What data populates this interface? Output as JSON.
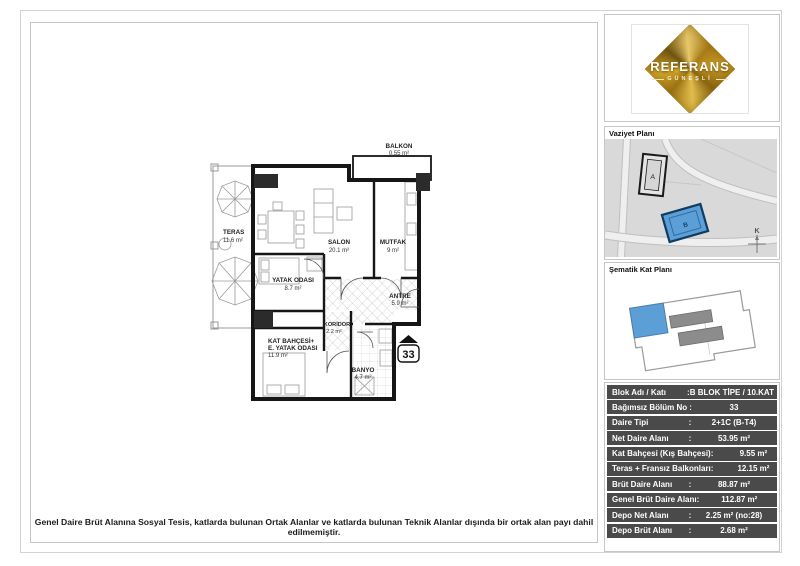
{
  "logo": {
    "name": "REFERANS",
    "subtitle": "GÜNEŞLİ"
  },
  "site_plan": {
    "title": "Vaziyet Planı",
    "building_a": "A",
    "building_b": "B",
    "north": "K"
  },
  "schematic": {
    "title": "Şematik Kat Planı"
  },
  "floor_plan": {
    "unit_number": "33",
    "rooms": {
      "teras": {
        "name": "TERAS",
        "area": "11.6  m²"
      },
      "salon": {
        "name": "SALON",
        "area": "20.1 m²"
      },
      "mutfak": {
        "name": "MUTFAK",
        "area": "9 m²"
      },
      "balkon": {
        "name": "BALKON",
        "area": "0.55 m²"
      },
      "yatak": {
        "name": "YATAK ODASI",
        "area": "8.7 m²"
      },
      "antre": {
        "name": "ANTRE",
        "area": "5.9 m²"
      },
      "koridor": {
        "name": "KORİDOR",
        "area": "2.2 m²"
      },
      "kat_bahcesi": {
        "name1": "KAT BAHÇESİ+",
        "name2": "E. YATAK ODASI",
        "area": "11.9 m²"
      },
      "banyo": {
        "name": "BANYO",
        "area": "4.7 m²"
      }
    }
  },
  "info_table": {
    "rows": [
      {
        "label": "Blok Adı / Katı",
        "sep": "",
        "value": ":B BLOK TİPE / 10.KAT"
      },
      {
        "label": "Bağımsız Bölüm No",
        "sep": ":",
        "value": "33"
      },
      {
        "label": "Daire Tipi",
        "sep": ":",
        "value": "2+1C (B-T4)"
      },
      {
        "label": "Net Daire Alanı",
        "sep": ":",
        "value": "53.95 m²"
      },
      {
        "label": "Kat Bahçesi (Kış Bahçesi)",
        "sep": ":",
        "value": "9.55 m²"
      },
      {
        "label": "Teras + Fransız Balkonları",
        "sep": ":",
        "value": "12.15 m²"
      },
      {
        "label": "Brüt Daire Alanı",
        "sep": ":",
        "value": "88.87 m²"
      },
      {
        "label": "Genel Brüt Daire Alanı",
        "sep": ":",
        "value": "112.87 m²"
      },
      {
        "label": "Depo Net Alanı",
        "sep": ":",
        "value": "2.25 m² (no:28)"
      },
      {
        "label": "Depo Brüt Alanı",
        "sep": ":",
        "value": "2.68 m²"
      }
    ]
  },
  "footer": {
    "note": "Genel Daire Brüt Alanına Sosyal Tesis, katlarda bulunan Ortak Alanlar ve katlarda bulunan Teknik Alanlar dışında bir ortak alan payı dahil edilmemiştir."
  },
  "colors": {
    "accent_blue": "#5C9FD6",
    "table_row_bg": "#4a4a4a",
    "gold": "#c59a28"
  }
}
